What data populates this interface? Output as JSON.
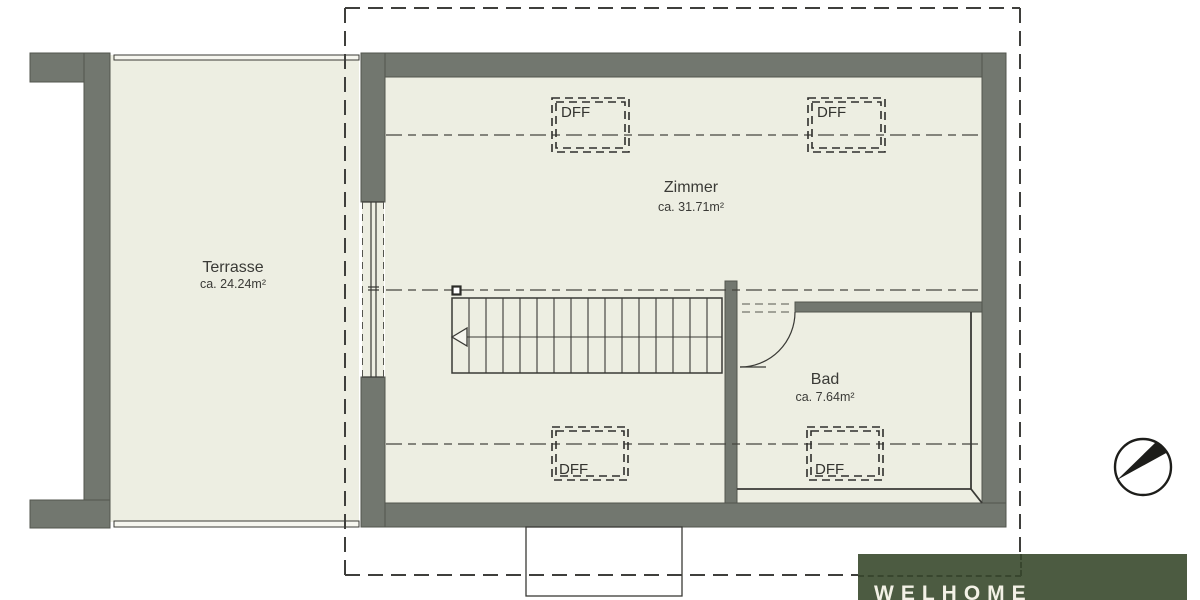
{
  "rooms": {
    "terrasse": {
      "name": "Terrasse",
      "area": "ca. 24.24m²"
    },
    "zimmer": {
      "name": "Zimmer",
      "area": "ca. 31.71m²"
    },
    "bad": {
      "name": "Bad",
      "area": "ca. 7.64m²"
    }
  },
  "skylights": {
    "labels": [
      "DFF",
      "DFF",
      "DFF",
      "DFF"
    ]
  },
  "branding": {
    "logo_text": "WELHOME"
  },
  "icons": {
    "north_arrow": "north-arrow"
  },
  "colors": {
    "wall_gray": "#72776f",
    "floor": "#edeee2",
    "logo_green": "#4c5b41",
    "logo_text_color": "#f3f1e6",
    "line_dark": "#3a3a36"
  }
}
